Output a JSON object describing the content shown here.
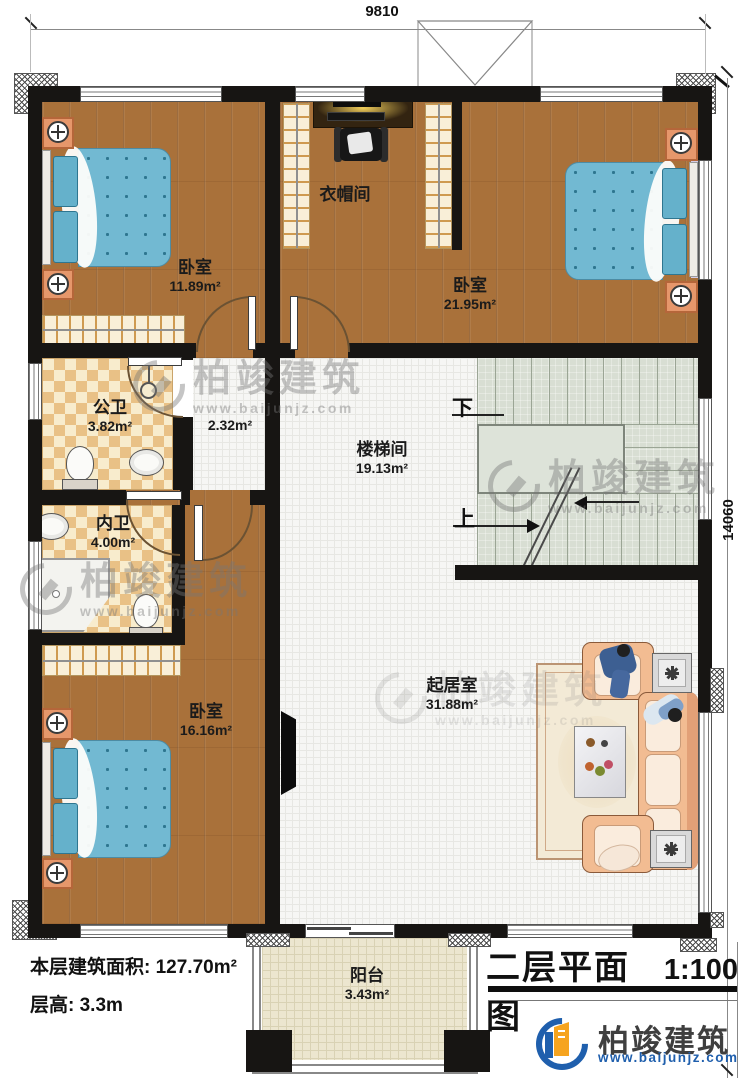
{
  "colors": {
    "wall": "#171513",
    "wood_floor": "#a9713a",
    "bath_tile": "#e9c186",
    "bed_blue": "#72b9d2",
    "sofa_peach": "#f2bc92",
    "stair_sage": "#d8ded3",
    "logo_blue": "#1f5fad",
    "logo_orange": "#f6a41f"
  },
  "dimensions": {
    "width_mm": "9810",
    "height_mm": "14060"
  },
  "rooms": {
    "bedroom_top_left": {
      "name": "卧室",
      "area": "11.89m²"
    },
    "cloakroom": {
      "name": "衣帽间"
    },
    "bedroom_top_right": {
      "name": "卧室",
      "area": "21.95m²"
    },
    "public_bathroom": {
      "name": "公卫",
      "area": "3.82m²"
    },
    "hallway": {
      "area": "2.32m²"
    },
    "stairwell": {
      "name": "楼梯间",
      "area": "19.13m²"
    },
    "private_bathroom": {
      "name": "内卫",
      "area": "4.00m²"
    },
    "bedroom_bottom": {
      "name": "卧室",
      "area": "16.16m²"
    },
    "living_room": {
      "name": "起居室",
      "area": "31.88m²"
    },
    "balcony": {
      "name": "阳台",
      "area": "3.43m²"
    }
  },
  "stairs": {
    "down_label": "下",
    "up_label": "上"
  },
  "footer": {
    "floor_area": "本层建筑面积: 127.70m²",
    "floor_height": "层高: 3.3m"
  },
  "title_block": {
    "title": "二层平面图",
    "scale": "1:100"
  },
  "brand": {
    "name": "柏竣建筑",
    "website": "www.baijunjz.com"
  },
  "watermark": {
    "name": "柏竣建筑",
    "website": "www.baijunjz.com"
  }
}
